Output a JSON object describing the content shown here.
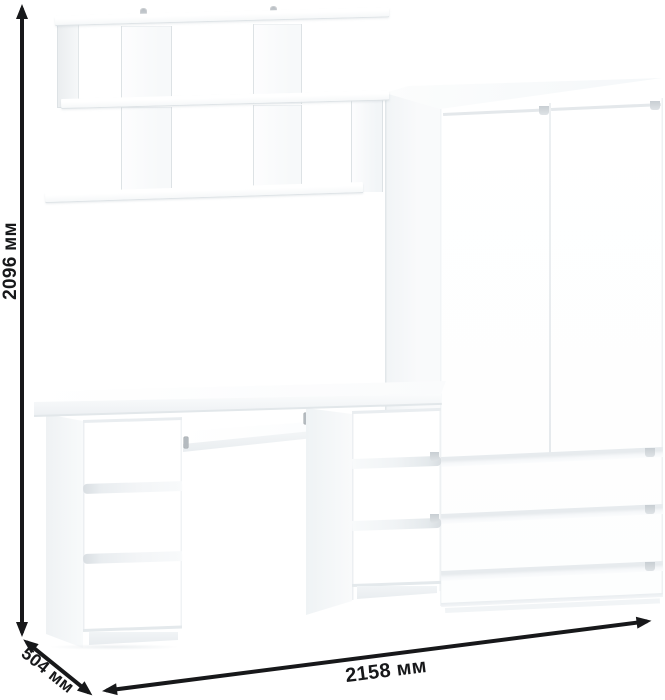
{
  "dimensions": {
    "height": "2096 мм",
    "depth": "504 мм",
    "width": "2158 мм"
  },
  "furniture": {
    "wall_shelf": {
      "tiers": 2,
      "mounting_hooks": 2
    },
    "desk": {
      "left_pedestal_drawers": 3,
      "right_pedestal_drawers": 3,
      "keyboard_tray": true
    },
    "wardrobe": {
      "doors": 2,
      "drawers": 3
    }
  },
  "colors": {
    "background": "#ffffff",
    "annotation": "#17181a",
    "furniture": "#ffffff",
    "edge_light": "#e2e7ea",
    "groove_dark": "#cbd1d6"
  }
}
